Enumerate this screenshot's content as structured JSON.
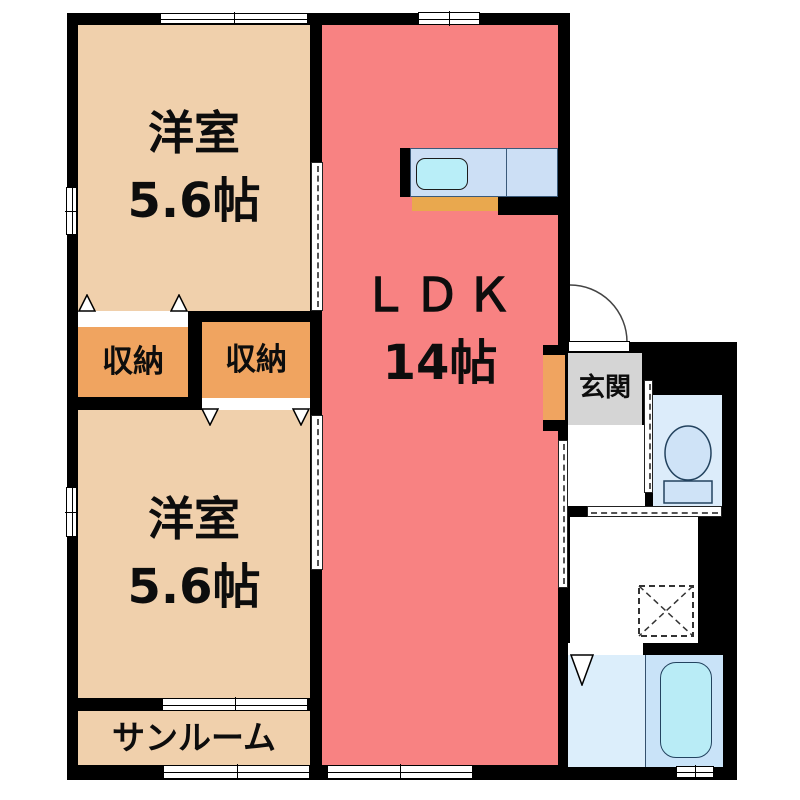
{
  "plan": {
    "rooms": {
      "room_top": {
        "label": "洋室",
        "size": "5.6帖"
      },
      "room_bottom": {
        "label": "洋室",
        "size": "5.6帖"
      },
      "ldk": {
        "label": "ＬＤＫ",
        "size": "14帖"
      },
      "closet_left": {
        "label": "収納"
      },
      "closet_right": {
        "label": "収納"
      },
      "sunroom": {
        "label": "サンルーム"
      },
      "entrance": {
        "label": "玄関"
      }
    },
    "icons": {
      "toilet": "toilet-icon",
      "bathtub": "bathtub-icon",
      "washing_machine": "washing-machine-icon",
      "kitchen_sink": "kitchen-sink-icon",
      "entrance_door": "door-swing-icon",
      "door_wedge": "door-wedge-icon"
    },
    "colors": {
      "wall": "#000000",
      "room": "#f0d0ac",
      "closet": "#f0a460",
      "ldk": "#f88282",
      "genkan": "#d5d5d5",
      "counter": "#ccdff5",
      "sink": "#b9eef8",
      "counter_tan": "#e9a84e",
      "toilet_room": "#dcecfa",
      "fixture": "#cfe3f7",
      "bath_floor": "#dceefb",
      "bath_inner": "#c9e3f8",
      "tub": "#b9ecf6",
      "line": "#333333"
    }
  }
}
